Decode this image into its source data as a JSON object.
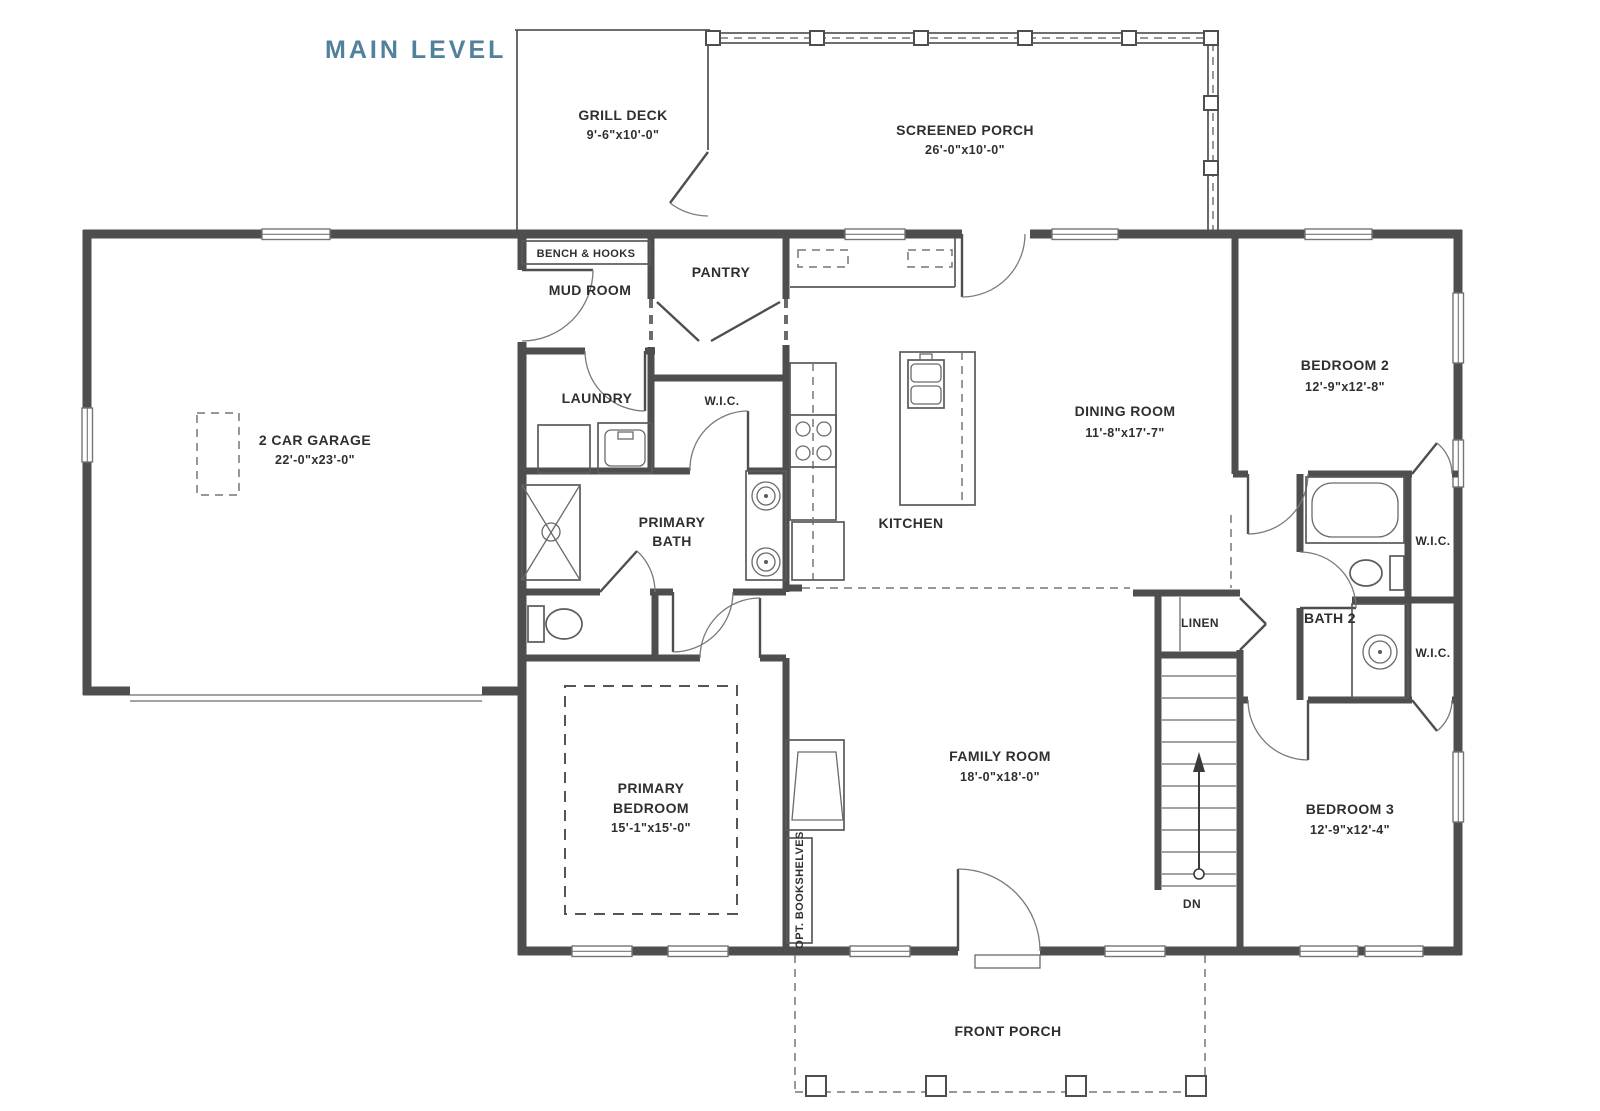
{
  "title": "MAIN LEVEL",
  "colors": {
    "title": "#52819c",
    "wall": "#4e4e4e",
    "text": "#2f2f2f",
    "background": "#ffffff"
  },
  "rooms": {
    "grill_deck": {
      "name": "GRILL DECK",
      "dims": "9'-6\"x10'-0\""
    },
    "screened_porch": {
      "name": "SCREENED PORCH",
      "dims": "26'-0\"x10'-0\""
    },
    "bench_hooks": {
      "name": "BENCH & HOOKS"
    },
    "mud_room": {
      "name": "MUD ROOM"
    },
    "pantry": {
      "name": "PANTRY"
    },
    "laundry": {
      "name": "LAUNDRY"
    },
    "wic_primary": {
      "name": "W.I.C."
    },
    "garage": {
      "name": "2 CAR GARAGE",
      "dims": "22'-0\"x23'-0\""
    },
    "primary_bath": {
      "name1": "PRIMARY",
      "name2": "BATH"
    },
    "kitchen": {
      "name": "KITCHEN"
    },
    "dining": {
      "name": "DINING ROOM",
      "dims": "11'-8\"x17'-7\""
    },
    "bedroom2": {
      "name": "BEDROOM 2",
      "dims": "12'-9\"x12'-8\""
    },
    "wic_bed2": {
      "name": "W.I.C."
    },
    "bath2": {
      "name": "BATH 2"
    },
    "linen": {
      "name": "LINEN"
    },
    "wic_bed3": {
      "name": "W.I.C."
    },
    "primary_bedroom": {
      "name1": "PRIMARY",
      "name2": "BEDROOM",
      "dims": "15'-1\"x15'-0\""
    },
    "family_room": {
      "name": "FAMILY ROOM",
      "dims": "18'-0\"x18'-0\""
    },
    "opt_bookshelves": {
      "name": "OPT. BOOKSHELVES"
    },
    "stairs": {
      "label": "DN"
    },
    "bedroom3": {
      "name": "BEDROOM 3",
      "dims": "12'-9\"x12'-4\""
    },
    "front_porch": {
      "name": "FRONT PORCH"
    }
  }
}
